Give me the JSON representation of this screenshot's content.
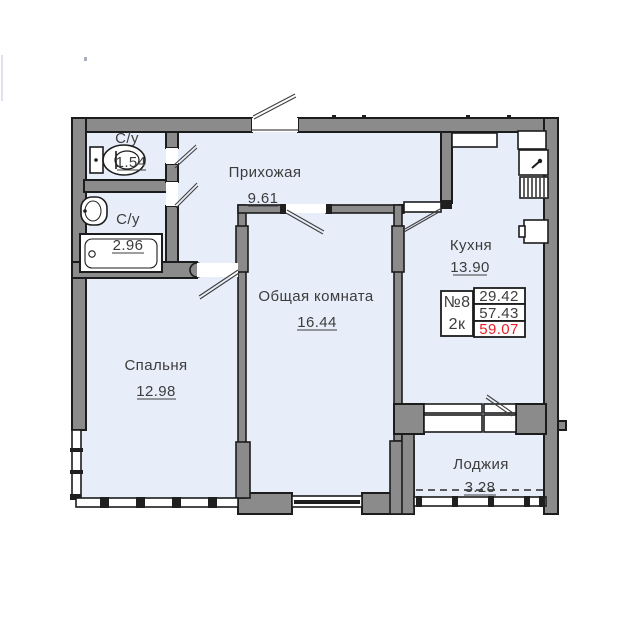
{
  "rooms": {
    "bathroom_small": {
      "label": "С/у",
      "area": "1.54"
    },
    "bathroom_large": {
      "label": "С/у",
      "area": "2.96"
    },
    "hallway": {
      "label": "Прихожая",
      "area": "9.61"
    },
    "kitchen": {
      "label": "Кухня",
      "area": "13.90"
    },
    "living_room": {
      "label": "Общая комната",
      "area": "16.44"
    },
    "bedroom": {
      "label": "Спальня",
      "area": "12.98"
    },
    "loggia": {
      "label": "Лоджия",
      "area": "3.28"
    }
  },
  "info_box": {
    "number": "№8",
    "type": "2к",
    "value_1": "29.42",
    "value_2": "57.43",
    "value_3": "59.07",
    "highlighted_value": "59.07"
  },
  "colors": {
    "wall_fill": "#8b8b8b",
    "wall_outline": "#1c1c1c",
    "floor": "#e7eefa",
    "highlight_red": "#e8202a",
    "text": "#3c3c3c"
  },
  "icons": [
    "toilet-icon",
    "washbasin-icon",
    "bathtub-icon",
    "kitchen-sink-icon",
    "stove-icon",
    "fridge-icon",
    "vent-duct",
    "door-swing"
  ]
}
